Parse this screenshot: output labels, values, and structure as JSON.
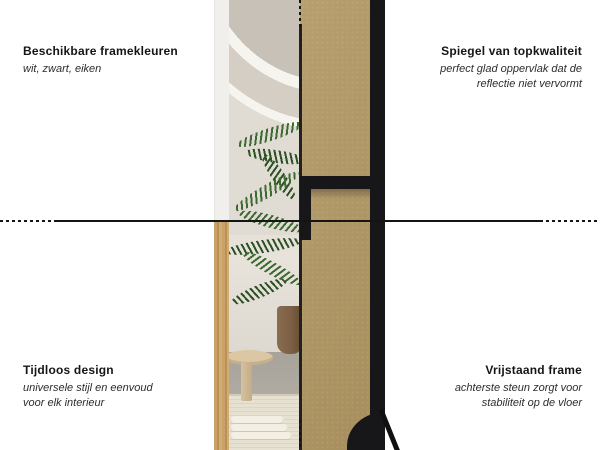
{
  "annotations": {
    "top_left": {
      "title": "Beschikbare framekleuren",
      "subtitle": "wit, zwart, eiken"
    },
    "top_right": {
      "title": "Spiegel van topkwaliteit",
      "subtitle": "perfect glad oppervlak dat de reflectie niet vervormt"
    },
    "bottom_left": {
      "title": "Tijdloos design",
      "subtitle": "universele stijl en eenvoud voor elk interieur"
    },
    "bottom_right": {
      "title": "Vrijstaand frame",
      "subtitle": "achterste steun zorgt voor stabiliteit op de vloer"
    }
  },
  "colors": {
    "background": "#ffffff",
    "text": "#1c1c1c",
    "line": "#141414",
    "mdf_board": "#b29763",
    "frame_black": "#17171a",
    "frame_white": "#f0efec",
    "frame_oak": "#c9a26a",
    "wall": "#ddd8d0",
    "plant_green": "#3d6a33",
    "floor": "#b0aca3",
    "rug": "#e7e1d2",
    "stool_wood": "#dcc7a5",
    "pot": "#7c5f45"
  }
}
